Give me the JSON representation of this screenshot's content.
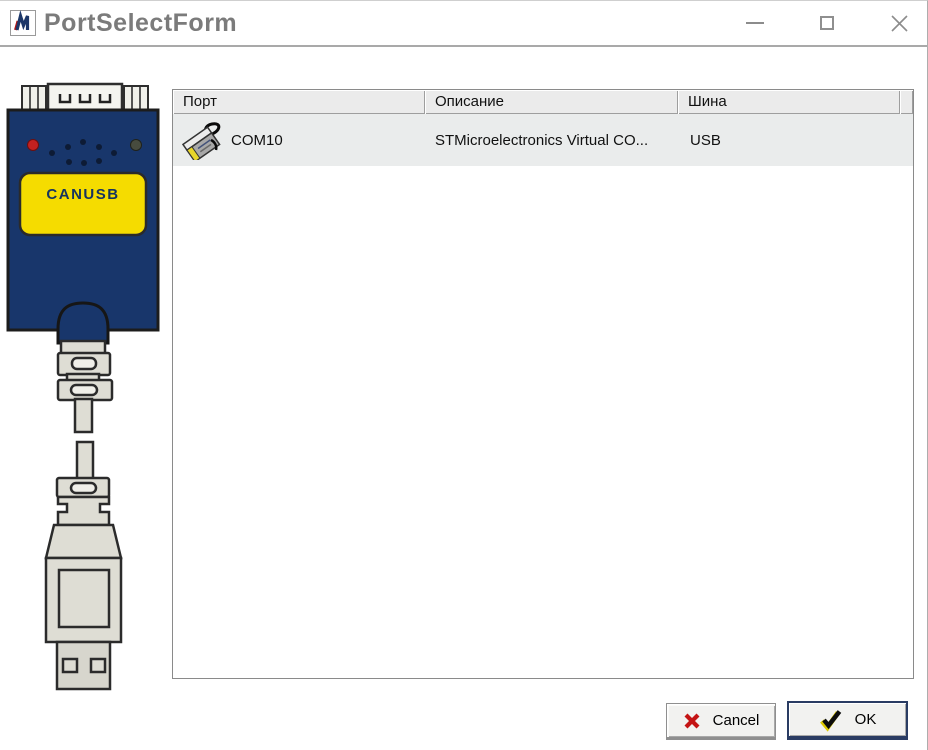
{
  "window": {
    "title": "PortSelectForm",
    "controls": {
      "minimize_icon": "minimize-icon",
      "maximize_icon": "maximize-icon",
      "close_icon": "close-icon"
    }
  },
  "device_illustration": {
    "label": "CANUSB"
  },
  "port_list": {
    "columns": [
      {
        "label": "Порт"
      },
      {
        "label": "Описание"
      },
      {
        "label": "Шина"
      }
    ],
    "rows": [
      {
        "icon": "serial-port-icon",
        "port": "COM10",
        "description": "STMicroelectronics Virtual CO...",
        "bus": "USB"
      }
    ]
  },
  "action_buttons": {
    "cancel": {
      "label": "Cancel",
      "icon": "red-x-icon"
    },
    "ok": {
      "label": "OK",
      "icon": "check-icon"
    }
  },
  "colors": {
    "device_body": "#18366b",
    "device_label_bg": "#f5dc00",
    "led_red": "#c22121",
    "cable_gray": "#deddd4",
    "row_highlight": "#eaecec",
    "header_bg": "#ebebeb",
    "title_text": "#7b7b7b",
    "cancel_icon_red": "#c41414",
    "ok_check_black": "#0c0c0c",
    "ok_check_yellow": "#ddc900"
  }
}
